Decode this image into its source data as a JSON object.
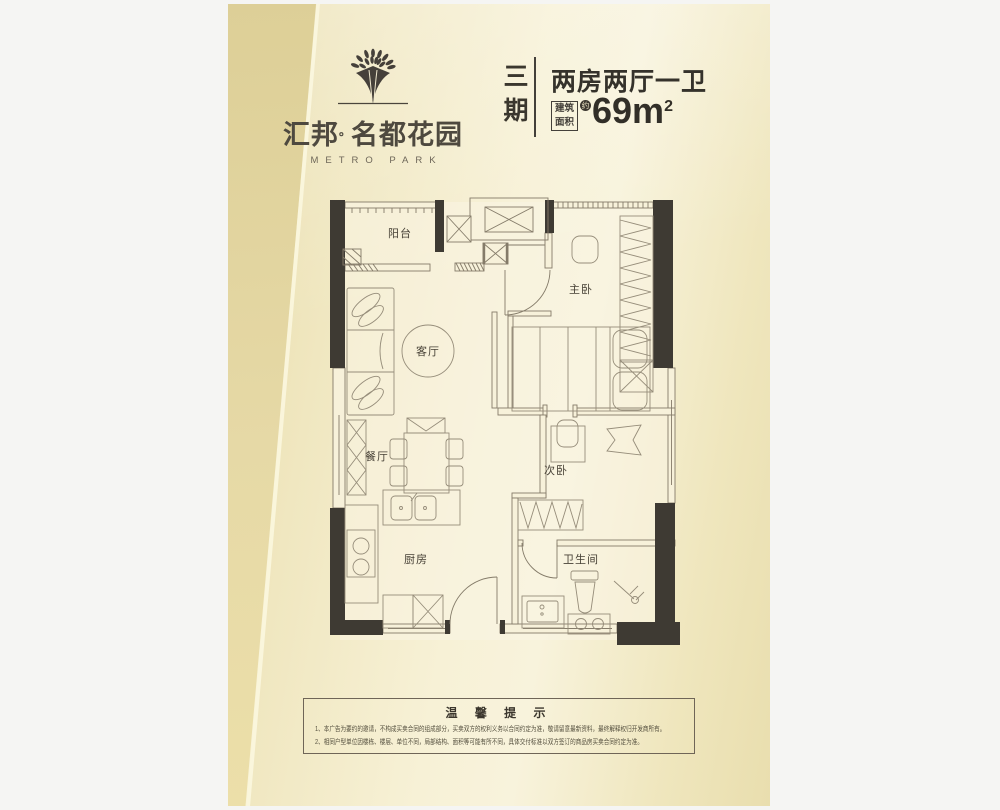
{
  "logo": {
    "brand_left": "汇邦",
    "separator": "。",
    "brand_right": "名都花园",
    "brand_en": "METRO PARK"
  },
  "header": {
    "phase": "三期",
    "unit_type": "两房两厅一卫",
    "area_label_top": "建筑",
    "area_label_bottom": "面积",
    "area_approx": "约",
    "area_value": "69m",
    "area_unit_sup": "2"
  },
  "floorplan": {
    "rooms": [
      {
        "id": "balcony",
        "label": "阳台"
      },
      {
        "id": "living-room",
        "label": "客厅"
      },
      {
        "id": "dining-room",
        "label": "餐厅"
      },
      {
        "id": "kitchen",
        "label": "厨房"
      },
      {
        "id": "master-bedroom",
        "label": "主卧"
      },
      {
        "id": "second-bedroom",
        "label": "次卧"
      },
      {
        "id": "bathroom",
        "label": "卫生间"
      }
    ],
    "colors": {
      "wall_pier": "#3e3a33",
      "wall_line": "#847b69",
      "paper": "#f8f3dc"
    }
  },
  "tips": {
    "title": "温 馨 提 示",
    "lines": [
      "1、本广告为要约的邀请，不构成买卖合同的组成部分，买卖双方的权利义务以合同约定为准，敬请留意最新资料，最终解释权归开发商所有。",
      "2、相同户型单位因楼栋、楼层、单位不同，局部结构、面积等可能有所不同，具体交付标准以双方签订的商品房买卖合同约定为准。"
    ]
  }
}
